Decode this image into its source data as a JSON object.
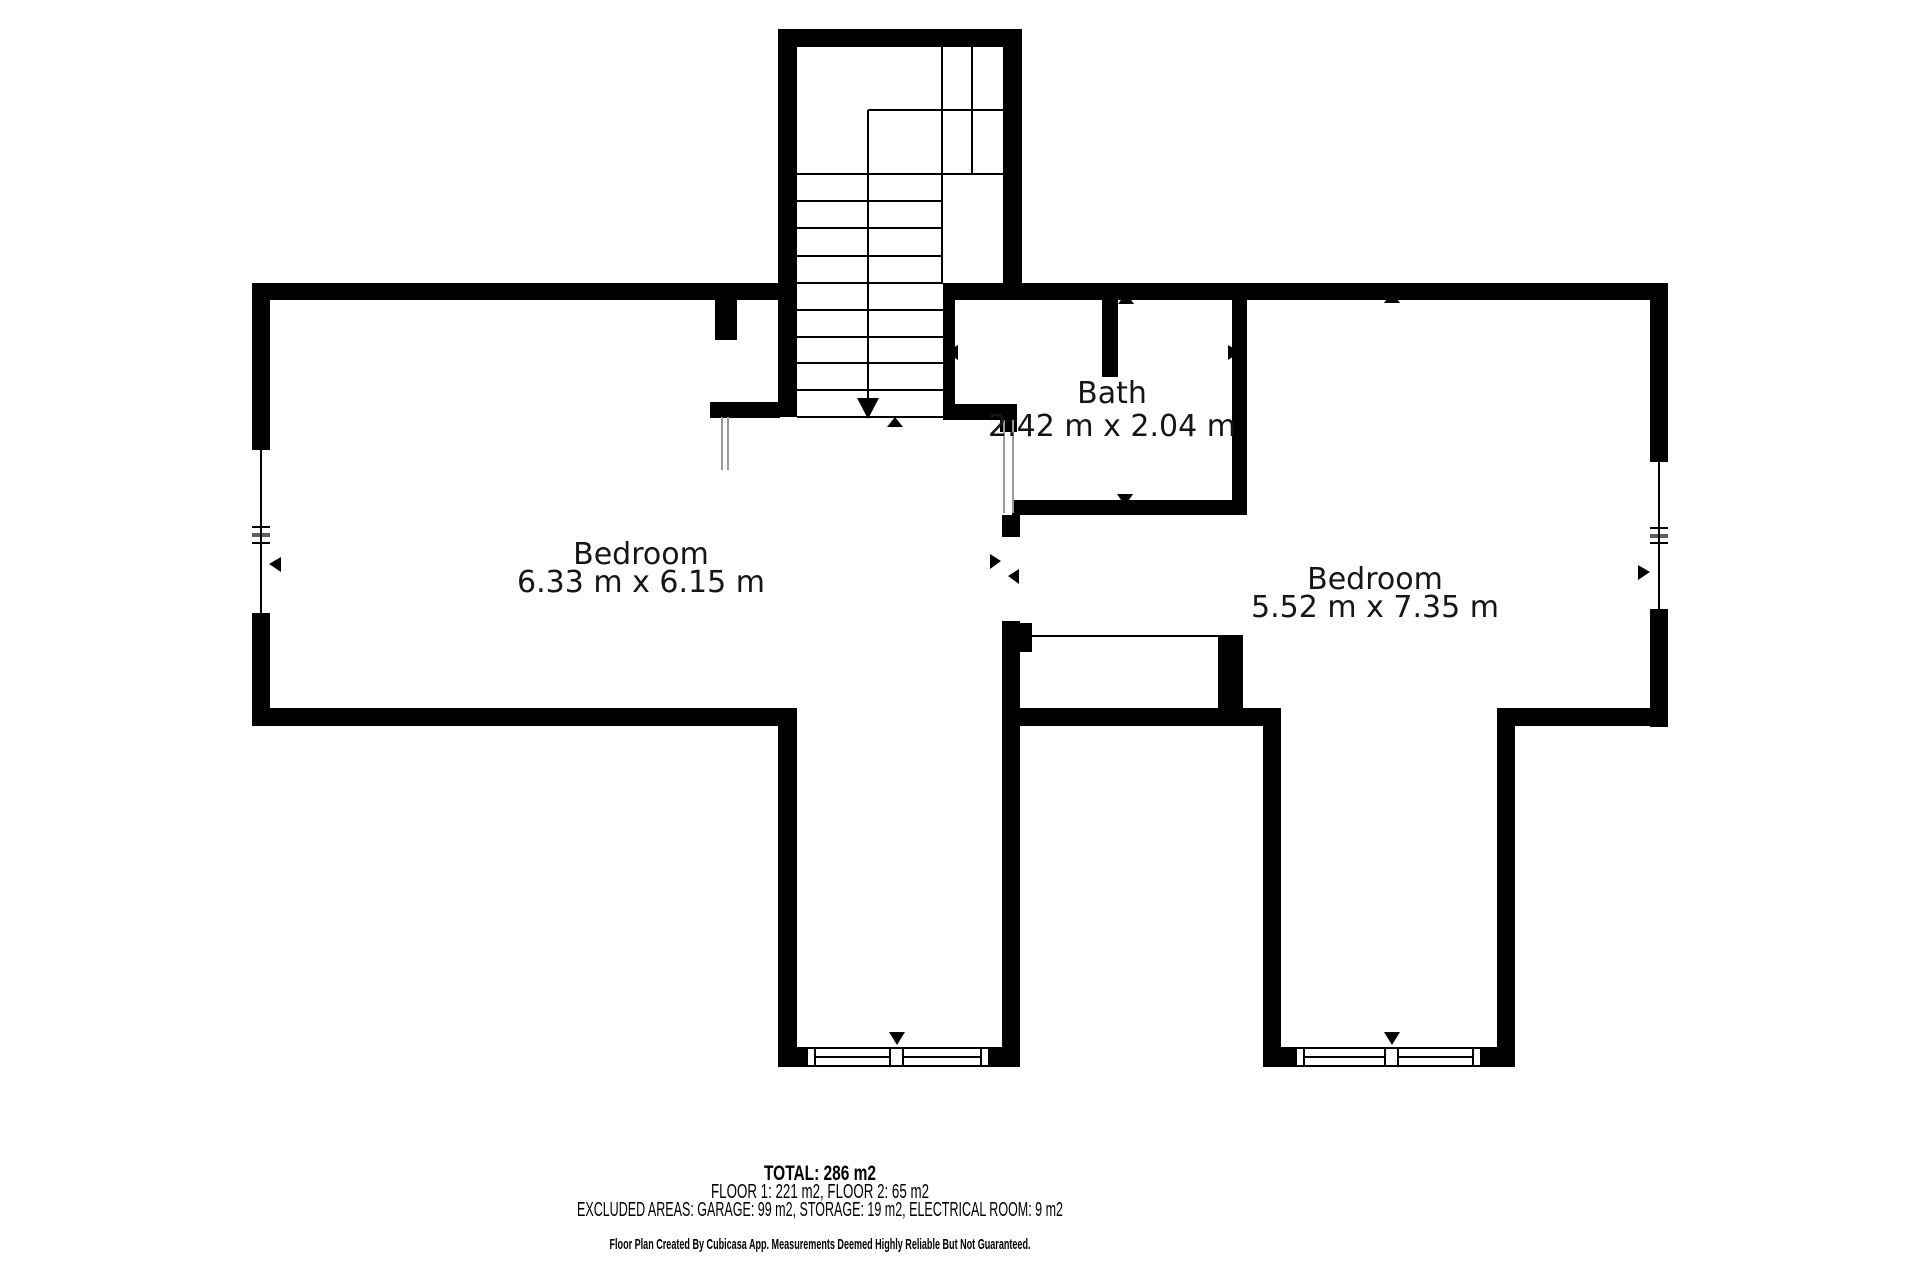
{
  "plan": {
    "rooms": [
      {
        "id": "bedroom-left",
        "name": "Bedroom",
        "dimensions": "6.33 m x 6.15 m"
      },
      {
        "id": "bath",
        "name": "Bath",
        "dimensions": "2.42 m x 2.04 m"
      },
      {
        "id": "bedroom-right",
        "name": "Bedroom",
        "dimensions": "5.52 m x 7.35 m"
      }
    ],
    "summary": {
      "total": "TOTAL: 286 m2",
      "floors": "FLOOR 1: 221 m2, FLOOR 2: 65 m2",
      "excluded": "EXCLUDED AREAS: GARAGE: 99 m2, STORAGE: 19 m2, ELECTRICAL ROOM: 9 m2"
    },
    "footer": "Floor Plan Created By Cubicasa App. Measurements Deemed Highly Reliable But Not Guaranteed.",
    "colors": {
      "wall": "#000000",
      "background": "#ffffff",
      "text": "#000000",
      "divider": "#9a9a9a"
    },
    "icons": {
      "stairs-down-arrow": "arrow-down",
      "door-marker": "small-triangle",
      "window-marker": "small-triangle"
    }
  }
}
